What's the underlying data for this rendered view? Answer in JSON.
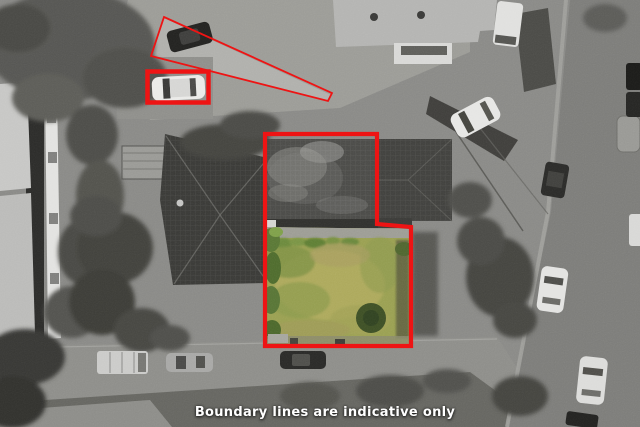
{
  "caption": "Boundary lines are indicative only",
  "colors": {
    "boundary_red": "#ee1414",
    "grass_base": "#9aa052",
    "grass_light": "#b3ac60",
    "grass_green": "#7e9145",
    "bush_dark": "#3e5026",
    "photo_gray": "#8a8a87"
  },
  "overlays": {
    "main_boundary": "property-boundary-outline",
    "vehicle_highlight": "highlighted-car-box",
    "driveway_outline": "access-strip-outline"
  }
}
